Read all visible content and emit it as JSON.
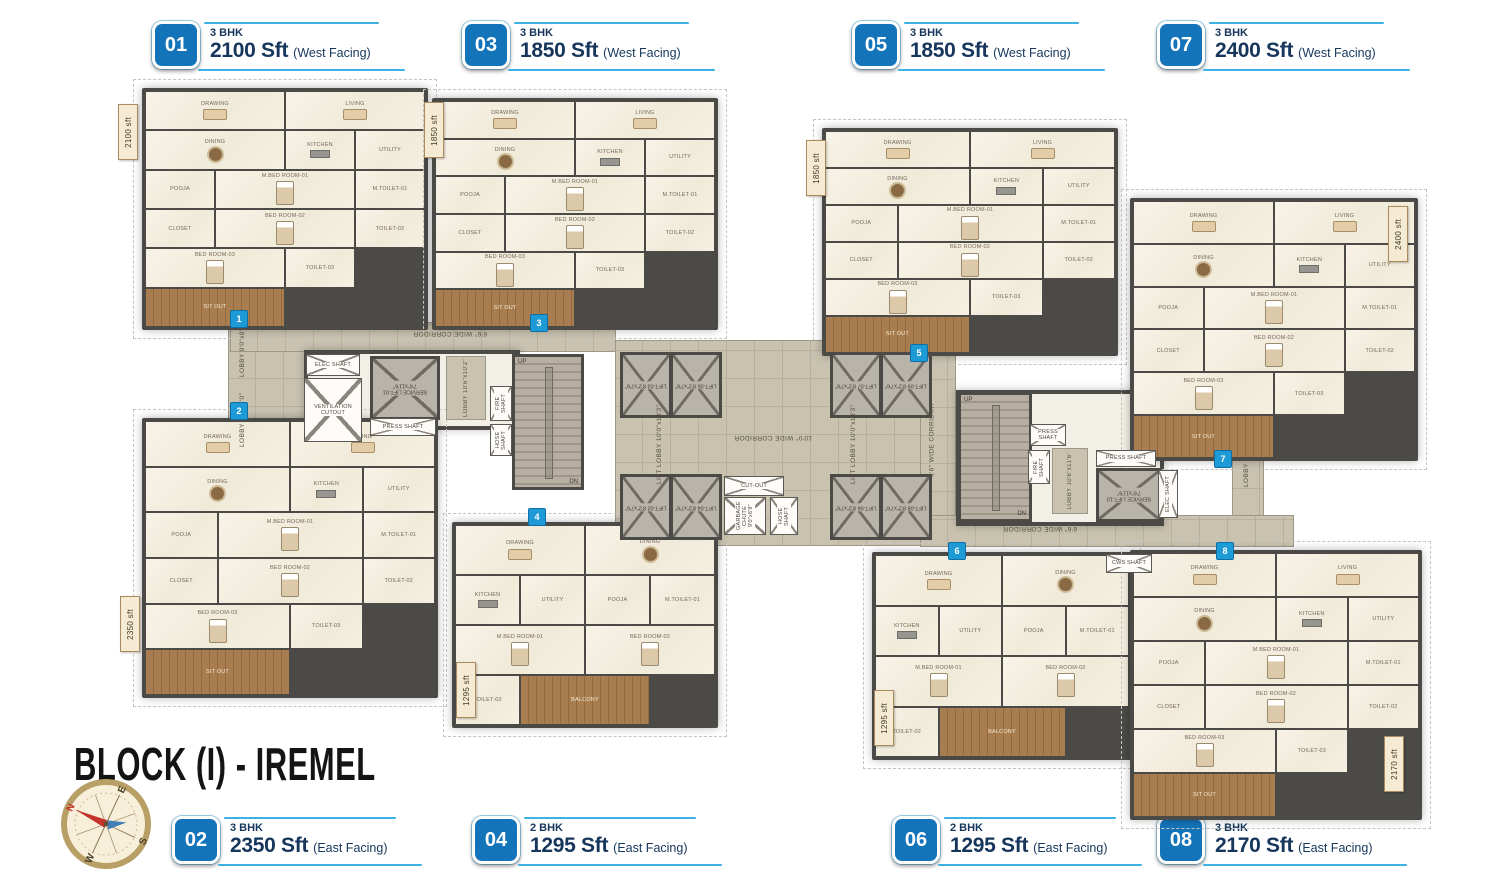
{
  "title": "BLOCK (I) - IREMEL",
  "compass": {
    "n": "N",
    "e": "E",
    "s": "S",
    "w": "W"
  },
  "legend_units": [
    {
      "num": "01",
      "bhk": "3 BHK",
      "area": "2100 Sft",
      "facing": "(West Facing)"
    },
    {
      "num": "03",
      "bhk": "3 BHK",
      "area": "1850 Sft",
      "facing": "(West Facing)"
    },
    {
      "num": "05",
      "bhk": "3 BHK",
      "area": "1850 Sft",
      "facing": "(West Facing)"
    },
    {
      "num": "07",
      "bhk": "3 BHK",
      "area": "2400 Sft",
      "facing": "(West Facing)"
    },
    {
      "num": "02",
      "bhk": "3 BHK",
      "area": "2350 Sft",
      "facing": "(East Facing)"
    },
    {
      "num": "04",
      "bhk": "2 BHK",
      "area": "1295 Sft",
      "facing": "(East Facing)"
    },
    {
      "num": "06",
      "bhk": "2 BHK",
      "area": "1295 Sft",
      "facing": "(East Facing)"
    },
    {
      "num": "08",
      "bhk": "3 BHK",
      "area": "2170 Sft",
      "facing": "(East Facing)"
    }
  ],
  "units": [
    {
      "id": "u01",
      "marker": "1",
      "area_tag": "2100 sft",
      "rooms": [
        "DRAWING",
        "LIVING",
        "DINING",
        "KITCHEN",
        "UTILITY",
        "POOJA",
        "M.BED ROOM-01",
        "M.TOILET-01",
        "CLOSET",
        "BED ROOM-02",
        "TOILET-02",
        "BED ROOM-03",
        "TOILET-03",
        "SIT OUT"
      ]
    },
    {
      "id": "u03",
      "marker": "3",
      "area_tag": "1850 sft",
      "rooms": [
        "DRAWING",
        "LIVING",
        "DINING",
        "KITCHEN",
        "UTILITY",
        "POOJA",
        "M.BED ROOM-01",
        "M.TOILET-01",
        "CLOSET",
        "BED ROOM-02",
        "TOILET-02",
        "BED ROOM-03",
        "TOILET-03",
        "SIT OUT"
      ]
    },
    {
      "id": "u05",
      "marker": "5",
      "area_tag": "1850 sft",
      "rooms": [
        "DRAWING",
        "LIVING",
        "DINING",
        "KITCHEN",
        "UTILITY",
        "POOJA",
        "M.BED ROOM-01",
        "M.TOILET-01",
        "CLOSET",
        "BED ROOM-02",
        "TOILET-02",
        "BED ROOM-03",
        "TOILET-03",
        "SIT OUT"
      ]
    },
    {
      "id": "u07",
      "marker": "7",
      "area_tag": "2400 sft",
      "rooms": [
        "DRAWING",
        "LIVING",
        "DINING",
        "KITCHEN",
        "UTILITY",
        "POOJA",
        "M.BED ROOM-01",
        "M.TOILET-01",
        "CLOSET",
        "BED ROOM-02",
        "TOILET-02",
        "BED ROOM-03",
        "TOILET-03",
        "SIT OUT"
      ]
    },
    {
      "id": "u02",
      "marker": "2",
      "area_tag": "2350 sft",
      "rooms": [
        "DRAWING",
        "LIVING",
        "DINING",
        "KITCHEN",
        "UTILITY",
        "POOJA",
        "M.BED ROOM-01",
        "M.TOILET-01",
        "CLOSET",
        "BED ROOM-02",
        "TOILET-02",
        "BED ROOM-03",
        "TOILET-03",
        "SIT OUT"
      ]
    },
    {
      "id": "u04",
      "marker": "4",
      "area_tag": "1295 sft",
      "rooms": [
        "DRAWING",
        "DINING",
        "KITCHEN",
        "UTILITY",
        "POOJA",
        "M.BED ROOM-01",
        "M.TOILET-01",
        "BED ROOM-02",
        "TOILET-02",
        "BALCONY"
      ]
    },
    {
      "id": "u06",
      "marker": "6",
      "area_tag": "1295 sft",
      "rooms": [
        "DRAWING",
        "DINING",
        "KITCHEN",
        "UTILITY",
        "POOJA",
        "M.BED ROOM-01",
        "M.TOILET-01",
        "BED ROOM-02",
        "TOILET-02",
        "BALCONY"
      ]
    },
    {
      "id": "u08",
      "marker": "8",
      "area_tag": "2170 sft",
      "rooms": [
        "DRAWING",
        "LIVING",
        "DINING",
        "KITCHEN",
        "UTILITY",
        "POOJA",
        "M.BED ROOM-01",
        "M.TOILET-01",
        "CLOSET",
        "BED ROOM-02",
        "TOILET-02",
        "BED ROOM-03",
        "TOILET-03",
        "SIT OUT"
      ]
    }
  ],
  "core": {
    "lifts_top": [
      "LIFT-03",
      "LIFT-05",
      "LIFT-07",
      "LIFT-09"
    ],
    "lifts_bottom": [
      "LIFT-02",
      "LIFT-04",
      "LIFT-06",
      "LIFT-08"
    ],
    "lift_dim": "8'2\"x7'6\"",
    "lift_lobby": "LIFT LOBBY 10'0\"x18'3\"",
    "corridor_main": "10'0\" WIDE CORRIDOR",
    "corridor_side": "6'6\" WIDE CORRIDOR",
    "service_lift_1": "SERVICE LIFT-01 7'6\"x11'6\"",
    "service_lift_10": "SERVICE LIFT-10 7'6\"x11'6\"",
    "garbage": "GARBAGE CHUTE 9'0\"x6'9\"",
    "cutout": "CUT-OUT",
    "vent": "VENTILATION CUTOUT",
    "elec": "ELEC SHAFT",
    "press": "PRESS SHAFT",
    "fire": "FIRE SHAFT",
    "hose": "HOSE SHAFT",
    "cws": "CWS SHAFT",
    "lobby_entry": "LOBBY 9'0\"x8'0\"",
    "lobby_l": "LOBBY 10'6\"x10'2\"",
    "lobby_r": "LOBBY 10'6\"x11'6\"",
    "lobby": "LOBBY",
    "stair_up": "UP",
    "stair_dn": "DN"
  },
  "colors": {
    "badge_blue": "#1474ba",
    "accent_blue": "#3bb1e4",
    "marker_blue": "#1e9bd7",
    "text_navy": "#16365c",
    "wall": "#4b4a47",
    "room_floor": "#f5f0e3",
    "corridor_floor": "#c8c2af",
    "wood": "#a87e50",
    "tag_cream": "#f5ead2",
    "compass_ring": "#b79f66"
  }
}
